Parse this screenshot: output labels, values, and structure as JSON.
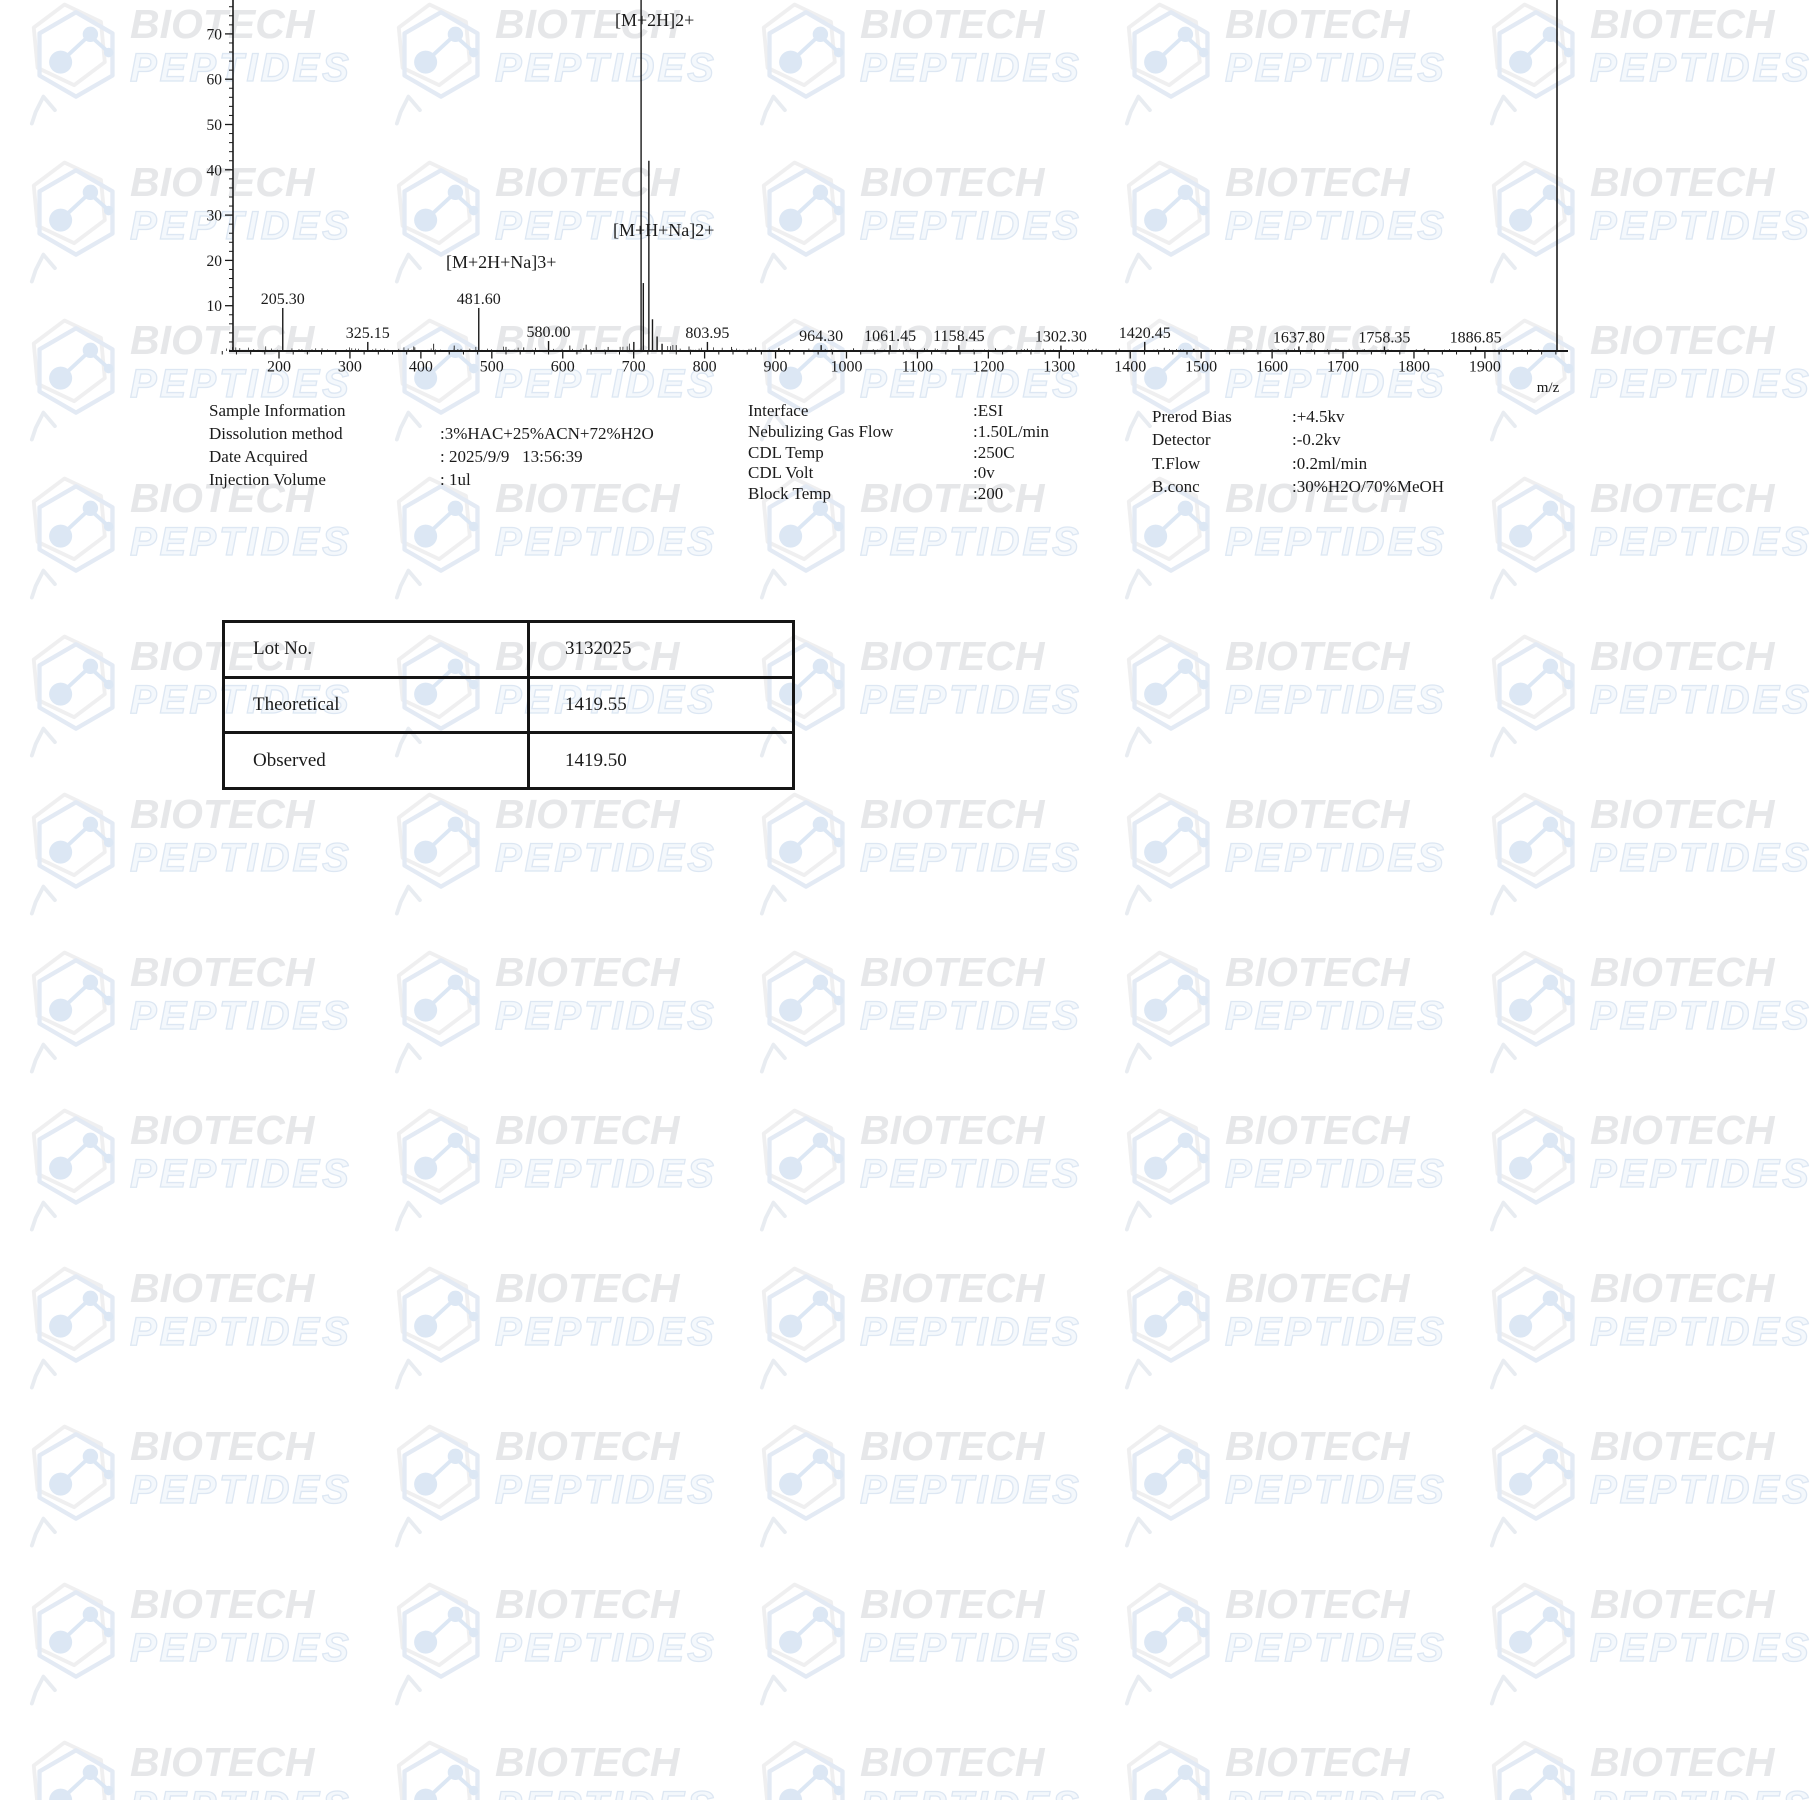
{
  "watermark": {
    "line1": "BIOTECH",
    "line2": "PEPTIDES",
    "icon": "hexagon-molecule-icon"
  },
  "chart_data": {
    "type": "bar",
    "subtype": "mass-spectrum",
    "title": "",
    "xlabel": "m/z",
    "ylabel": "",
    "x_axis_range": [
      120,
      2000
    ],
    "x_major_ticks": [
      200,
      300,
      400,
      500,
      600,
      700,
      800,
      900,
      1000,
      1100,
      1200,
      1300,
      1400,
      1500,
      1600,
      1700,
      1800,
      1900
    ],
    "y_visible_range": [
      0,
      77
    ],
    "y_major_ticks": [
      10,
      20,
      30,
      40,
      50,
      60,
      70
    ],
    "grid": "off",
    "peaks": [
      {
        "mz": 205.3,
        "intensity": 9.5,
        "label": "205.30"
      },
      {
        "mz": 325.15,
        "intensity": 2.0,
        "label": "325.15"
      },
      {
        "mz": 481.6,
        "intensity": 9.5,
        "label": "481.60"
      },
      {
        "mz": 580.0,
        "intensity": 2.2,
        "label": "580.00"
      },
      {
        "mz": 700.2,
        "intensity": 2.0
      },
      {
        "mz": 710.45,
        "intensity": 100,
        "clipped": true
      },
      {
        "mz": 713.6,
        "intensity": 15
      },
      {
        "mz": 721.4,
        "intensity": 42
      },
      {
        "mz": 726.5,
        "intensity": 7
      },
      {
        "mz": 733.0,
        "intensity": 3.2
      },
      {
        "mz": 740.0,
        "intensity": 1.6
      },
      {
        "mz": 803.95,
        "intensity": 2.0,
        "label": "803.95"
      },
      {
        "mz": 964.3,
        "intensity": 1.3,
        "label": "964.30"
      },
      {
        "mz": 1061.45,
        "intensity": 1.3,
        "label": "1061.45"
      },
      {
        "mz": 1158.45,
        "intensity": 1.3,
        "label": "1158.45"
      },
      {
        "mz": 1302.3,
        "intensity": 1.2,
        "label": "1302.30"
      },
      {
        "mz": 1420.45,
        "intensity": 2.0,
        "label": "1420.45"
      },
      {
        "mz": 1637.8,
        "intensity": 1.0,
        "label": "1637.80"
      },
      {
        "mz": 1758.35,
        "intensity": 1.0,
        "label": "1758.35"
      },
      {
        "mz": 1886.85,
        "intensity": 1.0,
        "label": "1886.85"
      }
    ],
    "minor_peaks": [
      {
        "mz": 390,
        "intensity": 1.0
      },
      {
        "mz": 418,
        "intensity": 1.6
      },
      {
        "mz": 447,
        "intensity": 1.2
      },
      {
        "mz": 520,
        "intensity": 0.9
      },
      {
        "mz": 545,
        "intensity": 0.8
      },
      {
        "mz": 610,
        "intensity": 1.2
      },
      {
        "mz": 633,
        "intensity": 1.4
      },
      {
        "mz": 664,
        "intensity": 0.9
      },
      {
        "mz": 760,
        "intensity": 1.3
      },
      {
        "mz": 778,
        "intensity": 1.0
      },
      {
        "mz": 838,
        "intensity": 0.9
      },
      {
        "mz": 872,
        "intensity": 0.8
      },
      {
        "mz": 905,
        "intensity": 0.7
      },
      {
        "mz": 1010,
        "intensity": 0.6
      },
      {
        "mz": 1110,
        "intensity": 0.6
      },
      {
        "mz": 1210,
        "intensity": 0.6
      },
      {
        "mz": 1255,
        "intensity": 0.5
      },
      {
        "mz": 1352,
        "intensity": 0.5
      },
      {
        "mz": 1448,
        "intensity": 0.7
      },
      {
        "mz": 1490,
        "intensity": 0.5
      },
      {
        "mz": 1560,
        "intensity": 0.5
      },
      {
        "mz": 1600,
        "intensity": 0.4
      },
      {
        "mz": 1690,
        "intensity": 0.5
      },
      {
        "mz": 1730,
        "intensity": 0.4
      },
      {
        "mz": 1815,
        "intensity": 0.5
      },
      {
        "mz": 1850,
        "intensity": 0.4
      },
      {
        "mz": 1930,
        "intensity": 0.4
      },
      {
        "mz": 1965,
        "intensity": 0.4
      }
    ],
    "annotations": [
      {
        "text": "[M+2H]2+",
        "mz": 710.45,
        "x": 615,
        "y": 26
      },
      {
        "text": "[M+H+Na]2+",
        "mz": 721.4,
        "x": 613,
        "y": 236
      },
      {
        "text": "[M+2H+Na]3+",
        "mz": 481.6,
        "x": 446,
        "y": 268
      }
    ]
  },
  "sample_info": {
    "title": "Sample Information",
    "col1": [
      {
        "label": "Dissolution method",
        "value": ":3%HAC+25%ACN+72%H2O"
      },
      {
        "label": "Date Acquired",
        "value": ": 2025/9/9   13:56:39"
      },
      {
        "label": "Injection Volume",
        "value": ": 1ul"
      }
    ],
    "col2": [
      {
        "label": "Interface",
        "value": ":ESI"
      },
      {
        "label": "Nebulizing Gas Flow",
        "value": ":1.50L/min"
      },
      {
        "label": "CDL Temp",
        "value": ":250C"
      },
      {
        "label": "CDL Volt",
        "value": ":0v"
      },
      {
        "label": "Block Temp",
        "value": ":200"
      }
    ],
    "col3": [
      {
        "label": "Prerod Bias",
        "value": ":+4.5kv"
      },
      {
        "label": "Detector",
        "value": ":-0.2kv"
      },
      {
        "label": "T.Flow",
        "value": ":0.2ml/min"
      },
      {
        "label": "B.conc",
        "value": ":30%H2O/70%MeOH"
      }
    ]
  },
  "results_table": {
    "rows": [
      {
        "label": "Lot No.",
        "value": "3132025"
      },
      {
        "label": "Theoretical",
        "value": "1419.55"
      },
      {
        "label": "Observed",
        "value": "1419.50"
      }
    ]
  }
}
